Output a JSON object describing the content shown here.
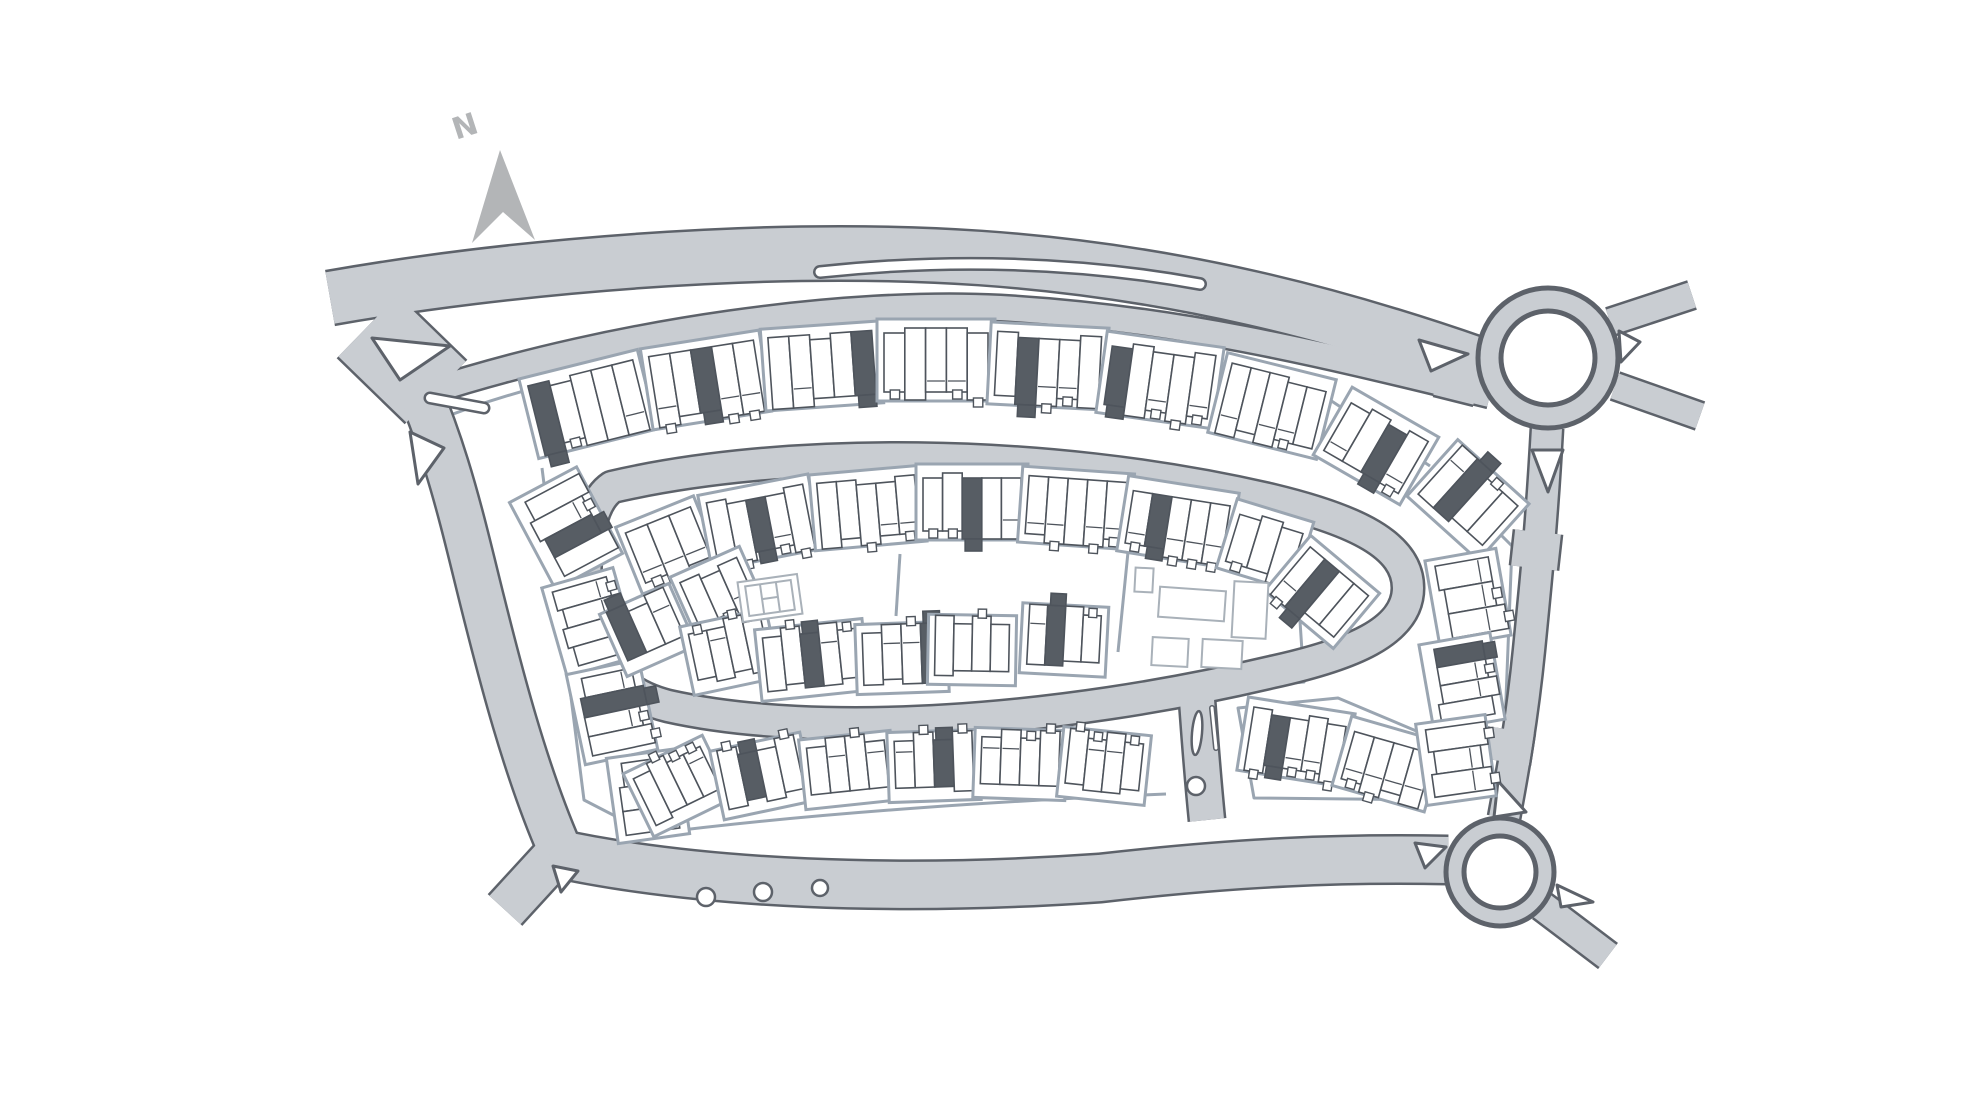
{
  "title": "Housing development siteplan",
  "compass": {
    "label": "N",
    "x": 468,
    "y": 136,
    "rotation": -18,
    "arrow_points": "500,150 535,240 503,212 472,243"
  },
  "colors": {
    "background": "#ffffff",
    "road_fill": "#c9cdd2",
    "road_casing": "#5d626a",
    "parcel_line": "#9aa5b1",
    "house_outline": "#4e545c",
    "house_fill": "#ffffff",
    "highlight_plot": "#575d64",
    "community_outline": "#a9b1b9",
    "compass_gray": "#b3b5b7"
  },
  "map": {
    "width": 1980,
    "height": 1115,
    "roads": [
      {
        "name": "main-road-west-entry",
        "d": "M 330,298 C 500,268 760,243 980,258 C 1180,272 1340,316 1478,364",
        "w": 52
      },
      {
        "name": "junction-patch",
        "d": "M 368,326 L 436,392",
        "w": 85
      },
      {
        "name": "north-street",
        "d": "M 428,392 C 620,330 850,300 1000,308 C 1180,318 1330,356 1490,395",
        "w": 24
      },
      {
        "name": "east-merge-patch",
        "d": "M 1440,368 L 1480,378",
        "w": 55
      },
      {
        "name": "west-perimeter-road",
        "d": "M 402,352 C 445,440 462,520 482,600 C 500,672 525,770 560,850",
        "w": 42
      },
      {
        "name": "southwest-exit",
        "d": "M 560,850 L 505,910",
        "w": 42
      },
      {
        "name": "south-perimeter-road",
        "d": "M 550,852 C 700,885 900,892 1100,878 C 1240,862 1340,858 1448,860",
        "w": 46
      },
      {
        "name": "spine-loop-road",
        "d": "M 612,487 C 780,448 1040,446 1272,500 C 1355,520 1408,545 1408,588 C 1408,632 1350,655 1272,672 C 1060,722 820,740 668,706 C 612,692 585,652 585,590 C 585,540 590,502 612,487 Z",
        "w": 30
      },
      {
        "name": "south-entrance-stub",
        "d": "M 1197,700 C 1200,740 1202,770 1207,820",
        "w": 34
      },
      {
        "name": "east-connector-road",
        "d": "M 1547,428 C 1542,520 1536,580 1529,650 C 1522,720 1512,775 1504,818",
        "w": 30
      },
      {
        "name": "connector-bulge-north",
        "d": "M 1538,532 L 1534,568",
        "w": 46
      },
      {
        "name": "connector-bulge-south",
        "d": "M 1512,730 L 1507,762",
        "w": 44
      },
      {
        "name": "northeast-exit",
        "d": "M 1610,322 L 1692,295",
        "w": 26
      },
      {
        "name": "east-exit",
        "d": "M 1615,386 L 1700,416",
        "w": 26
      },
      {
        "name": "southeast-exit",
        "d": "M 1542,906 L 1608,956",
        "w": 28
      }
    ],
    "roundabouts": [
      {
        "name": "north-roundabout",
        "cx": 1548,
        "cy": 358,
        "r_outer": 70,
        "r_inner": 47
      },
      {
        "name": "south-roundabout",
        "cx": 1500,
        "cy": 872,
        "r_outer": 54,
        "r_inner": 36
      }
    ],
    "islands": {
      "polygons": [
        {
          "name": "junction-island-north",
          "d": "M 372,338 L 450,346 L 400,380 Z"
        },
        {
          "name": "junction-island-mid",
          "d": "M 410,432 L 444,448 L 418,484 Z"
        },
        {
          "name": "southwest-bend-island",
          "d": "M 553,866 L 578,871 L 561,892 Z"
        },
        {
          "name": "north-roundabout-west-island",
          "d": "M 1419,340 L 1468,354 L 1431,371 Z"
        },
        {
          "name": "north-roundabout-south-island",
          "d": "M 1532,450 L 1563,450 L 1548,492 Z"
        },
        {
          "name": "north-roundabout-east-island",
          "d": "M 1619,331 L 1640,342 L 1621,362 Z"
        },
        {
          "name": "south-roundabout-north-island",
          "d": "M 1498,781 L 1526,812 L 1494,817 Z"
        },
        {
          "name": "south-roundabout-west-island",
          "d": "M 1415,843 L 1446,847 L 1425,868 Z"
        },
        {
          "name": "south-roundabout-se-island",
          "d": "M 1557,885 L 1593,902 L 1561,907 Z"
        }
      ],
      "slots": [
        {
          "name": "junction-median",
          "d": "M 430,398 L 484,408",
          "w": 8
        },
        {
          "name": "layby-median",
          "d": "M 820,272 C 950,258 1080,262 1200,284",
          "w": 9
        }
      ],
      "ellipses": [
        {
          "name": "stub-median-oval",
          "cx": 1197,
          "cy": 733,
          "rx": 5,
          "ry": 22,
          "rot": 5
        },
        {
          "name": "stub-median-circle",
          "cx": 1196,
          "cy": 786,
          "rx": 9,
          "ry": 9,
          "rot": 0
        }
      ],
      "lines": [
        {
          "name": "stub-median-sliver",
          "d": "M 1212,708 L 1216,748",
          "w": 3
        }
      ]
    },
    "notches": [
      {
        "cx": 706,
        "cy": 897,
        "r": 9
      },
      {
        "cx": 763,
        "cy": 892,
        "r": 9
      },
      {
        "cx": 820,
        "cy": 888,
        "r": 8
      }
    ],
    "parcel_lines": [
      "M 438,420 C 640,338 1010,306 1330,400 L 1430,466",
      "M 542,468 L 584,800 L 650,834",
      "M 650,834 C 820,812 1020,800 1166,794",
      "M 1436,470 L 1512,546 L 1502,800",
      "M 1128,552 L 1296,560 L 1304,682 L 1198,692",
      "M 1128,552 L 1118,652",
      "M 900,554 L 896,616",
      "M 1238,708 L 1338,698 L 1452,746 L 1442,800 L 1254,798 Z"
    ],
    "blocks_legend": "[cx, cy, rotation, width, height, units, dark_unit_index_or_null, front_side(1=local+y,-1=local-y)]",
    "blocks": [
      [
        588,
        404,
        -14,
        108,
        64,
        5,
        0,
        1
      ],
      [
        706,
        380,
        -9,
        106,
        64,
        5,
        2,
        1
      ],
      [
        822,
        366,
        -4,
        104,
        64,
        5,
        4,
        1
      ],
      [
        936,
        360,
        0,
        104,
        64,
        5,
        null,
        1
      ],
      [
        1048,
        366,
        3,
        104,
        64,
        5,
        1,
        1
      ],
      [
        1160,
        380,
        8,
        104,
        64,
        5,
        0,
        1
      ],
      [
        1272,
        406,
        14,
        98,
        64,
        5,
        null,
        1
      ],
      [
        1376,
        446,
        30,
        86,
        60,
        4,
        2,
        1
      ],
      [
        566,
        528,
        62,
        84,
        58,
        4,
        2,
        -1
      ],
      [
        590,
        622,
        74,
        78,
        56,
        4,
        null,
        -1
      ],
      [
        612,
        712,
        78,
        78,
        56,
        4,
        1,
        -1
      ],
      [
        648,
        796,
        82,
        72,
        54,
        3,
        null,
        -1
      ],
      [
        668,
        545,
        -22,
        70,
        54,
        3,
        null,
        1
      ],
      [
        760,
        522,
        -11,
        98,
        58,
        5,
        2,
        1
      ],
      [
        868,
        508,
        -5,
        98,
        58,
        5,
        null,
        1
      ],
      [
        972,
        502,
        0,
        98,
        58,
        5,
        2,
        1
      ],
      [
        1076,
        508,
        4,
        98,
        58,
        5,
        null,
        1
      ],
      [
        1178,
        522,
        9,
        98,
        58,
        5,
        1,
        1
      ],
      [
        1265,
        545,
        17,
        66,
        54,
        3,
        null,
        1
      ],
      [
        718,
        592,
        -24,
        62,
        48,
        3,
        null,
        1
      ],
      [
        1322,
        592,
        40,
        76,
        54,
        4,
        1,
        1
      ],
      [
        648,
        630,
        -24,
        62,
        50,
        3,
        0,
        -1
      ],
      [
        730,
        652,
        -12,
        74,
        52,
        4,
        null,
        -1
      ],
      [
        812,
        660,
        -6,
        94,
        54,
        5,
        2,
        -1
      ],
      [
        902,
        658,
        -2,
        78,
        52,
        4,
        3,
        -1
      ],
      [
        972,
        650,
        1,
        74,
        52,
        4,
        null,
        -1
      ],
      [
        1064,
        640,
        3,
        72,
        52,
        4,
        1,
        -1
      ],
      [
        678,
        786,
        -26,
        74,
        52,
        4,
        null,
        -1
      ],
      [
        762,
        776,
        -12,
        78,
        52,
        4,
        1,
        -1
      ],
      [
        848,
        770,
        -6,
        78,
        52,
        4,
        null,
        -1
      ],
      [
        934,
        766,
        -2,
        78,
        52,
        4,
        2,
        -1
      ],
      [
        1020,
        764,
        2,
        78,
        52,
        4,
        null,
        -1
      ],
      [
        1104,
        766,
        6,
        74,
        52,
        4,
        null,
        -1
      ],
      [
        1296,
        742,
        9,
        94,
        56,
        5,
        1,
        1
      ],
      [
        1388,
        764,
        16,
        82,
        54,
        4,
        null,
        1
      ],
      [
        1468,
        500,
        42,
        82,
        58,
        4,
        1,
        -1
      ],
      [
        1468,
        598,
        80,
        74,
        54,
        3,
        null,
        -1
      ],
      [
        1462,
        682,
        80,
        74,
        54,
        4,
        0,
        -1
      ],
      [
        1456,
        760,
        82,
        68,
        52,
        3,
        null,
        -1
      ]
    ],
    "community_buildings": [
      {
        "cx": 1144,
        "cy": 580,
        "w": 18,
        "h": 24,
        "rot": 3
      },
      {
        "cx": 1192,
        "cy": 604,
        "w": 66,
        "h": 30,
        "rot": 4
      },
      {
        "cx": 1250,
        "cy": 610,
        "w": 34,
        "h": 56,
        "rot": 3
      },
      {
        "cx": 1170,
        "cy": 652,
        "w": 36,
        "h": 28,
        "rot": 3
      },
      {
        "cx": 1222,
        "cy": 654,
        "w": 40,
        "h": 28,
        "rot": 3
      }
    ],
    "court": {
      "cx": 770,
      "cy": 598,
      "rot": -8,
      "outer_w": 60,
      "outer_h": 40,
      "inner_w": 46,
      "inner_h": 30
    }
  }
}
